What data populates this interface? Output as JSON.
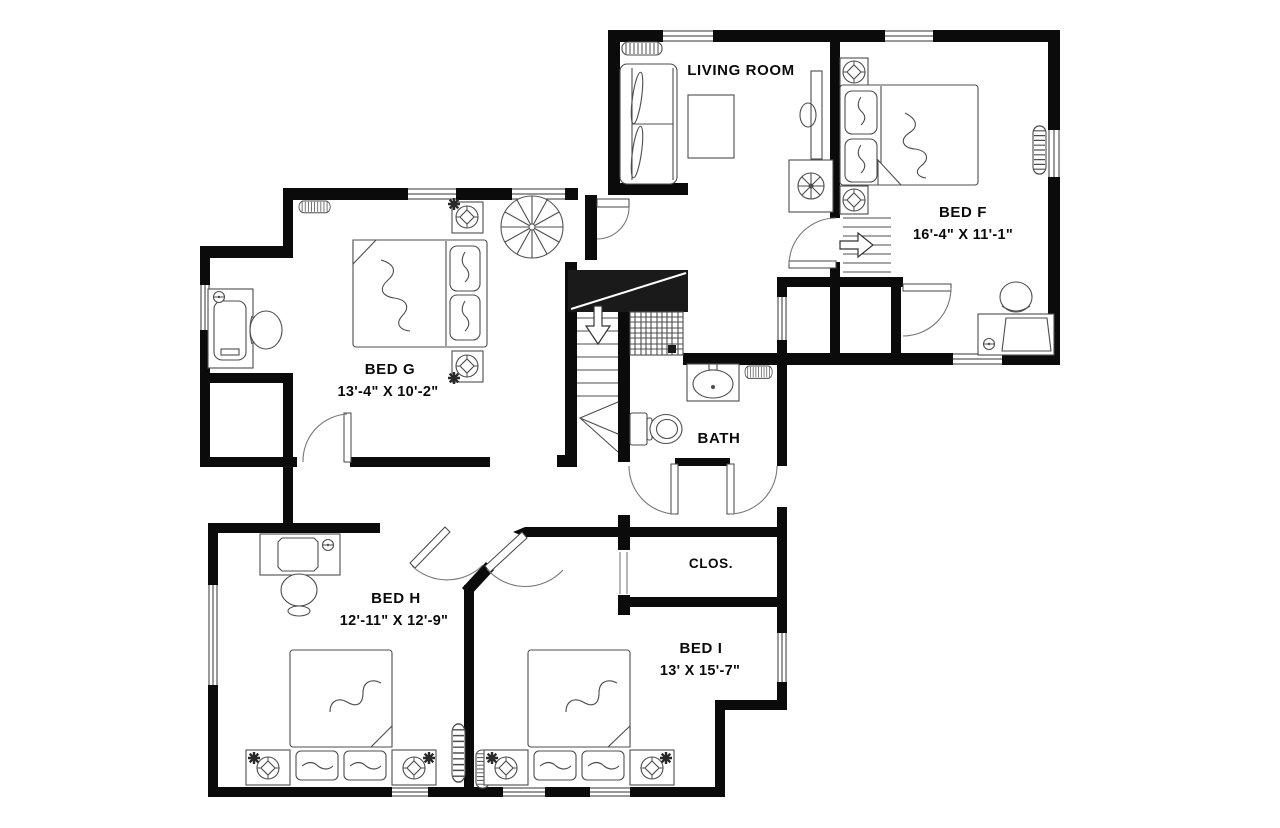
{
  "floor_plan": {
    "background_color": "#ffffff",
    "wall_color": "#0b0b0b",
    "furniture_line_color": "#4d4d4d",
    "rooms": [
      {
        "name": "LIVING ROOM",
        "dims": ""
      },
      {
        "name": "BED F",
        "dims": "16'-4\" X 11'-1\""
      },
      {
        "name": "BED G",
        "dims": "13'-4\" X 10'-2\""
      },
      {
        "name": "BATH",
        "dims": ""
      },
      {
        "name": "CLOS.",
        "dims": ""
      },
      {
        "name": "BED H",
        "dims": "12'-11\" X 12'-9\""
      },
      {
        "name": "BED I",
        "dims": "13' X 15'-7\""
      }
    ],
    "features": [
      "spiral-staircase",
      "staircase-down",
      "staircase-up",
      "shower",
      "toilet",
      "sink",
      "closet"
    ]
  }
}
